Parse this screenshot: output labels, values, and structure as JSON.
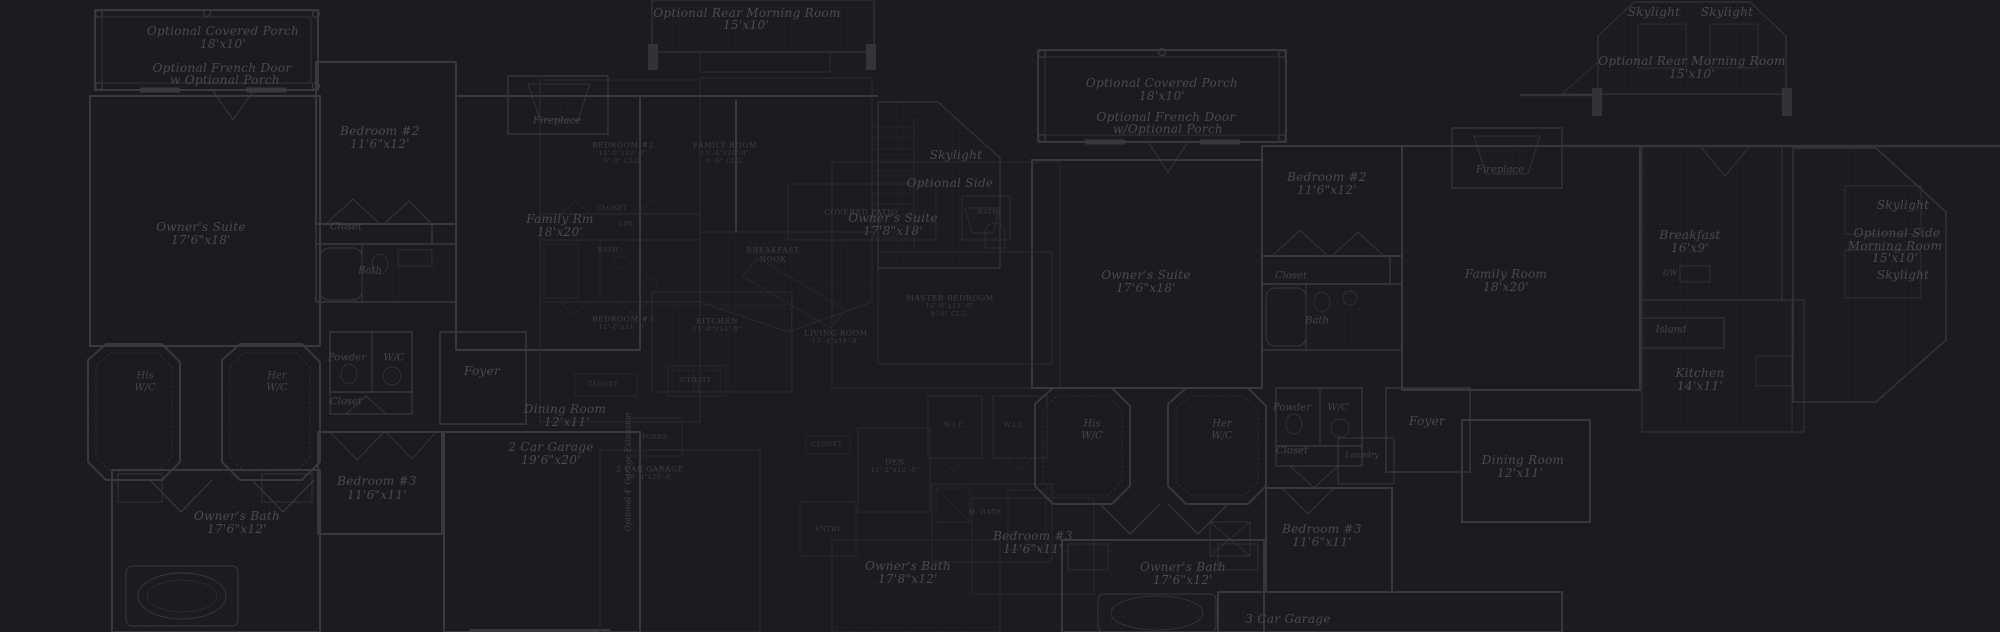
{
  "meta": {
    "title": "Dark floor-plan blueprint collage"
  },
  "canvas": {
    "width": 2000,
    "height": 632,
    "background": "#1c1b1e",
    "wall_color": "#39383f",
    "wall_color_secondary": "#2d2c33",
    "tile_grid_color": "#26252c",
    "label_color_italic": "#4b4854",
    "label_color_caps": "#413e49"
  },
  "labels": [
    {
      "text": "Optional Covered Porch",
      "x": 223,
      "y": 31,
      "cls": "it",
      "name": "label-optional-covered-porch"
    },
    {
      "text": "18'x10'",
      "x": 223,
      "y": 44,
      "cls": "it"
    },
    {
      "text": "Optional French Door",
      "x": 222,
      "y": 68,
      "cls": "it",
      "name": "label-optional-french-door"
    },
    {
      "text": "w Optional Porch",
      "x": 225,
      "y": 80,
      "cls": "it"
    },
    {
      "text": "Bedroom #2",
      "x": 380,
      "y": 131,
      "cls": "it",
      "name": "label-bedroom-2"
    },
    {
      "text": "11'6\"x12'",
      "x": 380,
      "y": 144,
      "cls": "it"
    },
    {
      "text": "Owner's Suite",
      "x": 201,
      "y": 227,
      "cls": "it",
      "name": "label-owners-suite"
    },
    {
      "text": "17'6\"x18'",
      "x": 201,
      "y": 240,
      "cls": "it"
    },
    {
      "text": "Closet",
      "x": 346,
      "y": 227,
      "cls": "itsm"
    },
    {
      "text": "Bath",
      "x": 370,
      "y": 271,
      "cls": "itsm"
    },
    {
      "text": "Fireplace",
      "x": 557,
      "y": 121,
      "cls": "itsm",
      "name": "label-fireplace"
    },
    {
      "text": "Family Rm",
      "x": 560,
      "y": 219,
      "cls": "it",
      "name": "label-family-rm"
    },
    {
      "text": "18'x20'",
      "x": 560,
      "y": 232,
      "cls": "it"
    },
    {
      "text": "His",
      "x": 145,
      "y": 376,
      "cls": "itsm"
    },
    {
      "text": "W/C",
      "x": 145,
      "y": 388,
      "cls": "itsm"
    },
    {
      "text": "Her",
      "x": 277,
      "y": 376,
      "cls": "itsm"
    },
    {
      "text": "W/C",
      "x": 277,
      "y": 388,
      "cls": "itsm"
    },
    {
      "text": "Powder",
      "x": 347,
      "y": 358,
      "cls": "itsm"
    },
    {
      "text": "W/C",
      "x": 394,
      "y": 358,
      "cls": "itsm"
    },
    {
      "text": "Closet",
      "x": 346,
      "y": 402,
      "cls": "itsm"
    },
    {
      "text": "Foyer",
      "x": 482,
      "y": 371,
      "cls": "it",
      "name": "label-foyer"
    },
    {
      "text": "Dining Room",
      "x": 565,
      "y": 409,
      "cls": "it"
    },
    {
      "text": "12'x11'",
      "x": 567,
      "y": 422,
      "cls": "it"
    },
    {
      "text": "Bedroom #3",
      "x": 377,
      "y": 481,
      "cls": "it",
      "name": "label-bedroom-3"
    },
    {
      "text": "11'6\"x11'",
      "x": 377,
      "y": 495,
      "cls": "it"
    },
    {
      "text": "Owner's Bath",
      "x": 237,
      "y": 516,
      "cls": "it",
      "name": "label-owners-bath"
    },
    {
      "text": "17'6\"x12'",
      "x": 237,
      "y": 529,
      "cls": "it"
    },
    {
      "text": "2 Car Garage",
      "x": 551,
      "y": 447,
      "cls": "it",
      "name": "label-2-car-garage"
    },
    {
      "text": "19'6\"x20'",
      "x": 551,
      "y": 460,
      "cls": "it"
    },
    {
      "text": "Optional 4' Garage Extension",
      "x": 628,
      "y": 472,
      "cls": "itxs",
      "rot": true,
      "name": "label-garage-extension"
    },
    {
      "text": "Skylight",
      "x": 956,
      "y": 155,
      "cls": "it",
      "name": "label-skylight"
    },
    {
      "text": "Optional Side",
      "x": 950,
      "y": 183,
      "cls": "it"
    },
    {
      "text": "Owner's Suite",
      "x": 893,
      "y": 218,
      "cls": "it"
    },
    {
      "text": "17'8\"x18'",
      "x": 893,
      "y": 231,
      "cls": "it"
    },
    {
      "text": "Owner's Bath",
      "x": 908,
      "y": 566,
      "cls": "it"
    },
    {
      "text": "17'8\"x12'",
      "x": 908,
      "y": 579,
      "cls": "it"
    },
    {
      "text": "Bedroom #3",
      "x": 1033,
      "y": 536,
      "cls": "it"
    },
    {
      "text": "11'6\"x11'",
      "x": 1033,
      "y": 549,
      "cls": "it"
    },
    {
      "text": "Optional Covered Porch",
      "x": 1162,
      "y": 83,
      "cls": "it"
    },
    {
      "text": "18'x10'",
      "x": 1162,
      "y": 96,
      "cls": "it"
    },
    {
      "text": "Optional French Door",
      "x": 1166,
      "y": 117,
      "cls": "it"
    },
    {
      "text": "w/Optional Porch",
      "x": 1168,
      "y": 129,
      "cls": "it"
    },
    {
      "text": "Bedroom #2",
      "x": 1327,
      "y": 177,
      "cls": "it"
    },
    {
      "text": "11'6\"x12'",
      "x": 1327,
      "y": 190,
      "cls": "it"
    },
    {
      "text": "Owner's Suite",
      "x": 1146,
      "y": 275,
      "cls": "it"
    },
    {
      "text": "17'6\"x18'",
      "x": 1146,
      "y": 288,
      "cls": "it"
    },
    {
      "text": "Closet",
      "x": 1291,
      "y": 276,
      "cls": "itsm"
    },
    {
      "text": "Bath",
      "x": 1317,
      "y": 321,
      "cls": "itsm"
    },
    {
      "text": "Fireplace",
      "x": 1500,
      "y": 170,
      "cls": "itsm"
    },
    {
      "text": "Family Room",
      "x": 1506,
      "y": 274,
      "cls": "it",
      "name": "label-family-room"
    },
    {
      "text": "18'x20'",
      "x": 1506,
      "y": 287,
      "cls": "it"
    },
    {
      "text": "Breakfast",
      "x": 1690,
      "y": 235,
      "cls": "it",
      "name": "label-breakfast"
    },
    {
      "text": "16'x9'",
      "x": 1690,
      "y": 248,
      "cls": "it"
    },
    {
      "text": "DW",
      "x": 1670,
      "y": 273,
      "cls": "itxs"
    },
    {
      "text": "Island",
      "x": 1671,
      "y": 330,
      "cls": "itsm",
      "name": "label-island"
    },
    {
      "text": "Kitchen",
      "x": 1700,
      "y": 373,
      "cls": "it",
      "name": "label-kitchen"
    },
    {
      "text": "14'x11'",
      "x": 1700,
      "y": 386,
      "cls": "it"
    },
    {
      "text": "Skylight",
      "x": 1903,
      "y": 205,
      "cls": "it"
    },
    {
      "text": "Optional Side",
      "x": 1897,
      "y": 233,
      "cls": "it",
      "name": "label-optional-side-morning-room"
    },
    {
      "text": "Morning Room",
      "x": 1895,
      "y": 246,
      "cls": "it"
    },
    {
      "text": "15'x10'",
      "x": 1895,
      "y": 258,
      "cls": "it"
    },
    {
      "text": "Skylight",
      "x": 1903,
      "y": 275,
      "cls": "it"
    },
    {
      "text": "His",
      "x": 1092,
      "y": 424,
      "cls": "itsm"
    },
    {
      "text": "W/C",
      "x": 1092,
      "y": 436,
      "cls": "itsm"
    },
    {
      "text": "Her",
      "x": 1222,
      "y": 424,
      "cls": "itsm"
    },
    {
      "text": "W/C",
      "x": 1222,
      "y": 436,
      "cls": "itsm"
    },
    {
      "text": "Powder",
      "x": 1292,
      "y": 408,
      "cls": "itsm"
    },
    {
      "text": "W/C",
      "x": 1338,
      "y": 408,
      "cls": "itsm"
    },
    {
      "text": "Closet",
      "x": 1292,
      "y": 451,
      "cls": "itsm"
    },
    {
      "text": "Foyer",
      "x": 1427,
      "y": 421,
      "cls": "it"
    },
    {
      "text": "Dining Room",
      "x": 1523,
      "y": 460,
      "cls": "it",
      "name": "label-dining-room"
    },
    {
      "text": "12'x11'",
      "x": 1520,
      "y": 473,
      "cls": "it"
    },
    {
      "text": "Laundry",
      "x": 1362,
      "y": 455,
      "cls": "itxs",
      "name": "label-laundry"
    },
    {
      "text": "Bedroom #3",
      "x": 1322,
      "y": 529,
      "cls": "it"
    },
    {
      "text": "11'6\"x11'",
      "x": 1322,
      "y": 542,
      "cls": "it"
    },
    {
      "text": "Owner's Bath",
      "x": 1183,
      "y": 567,
      "cls": "it"
    },
    {
      "text": "17'6\"x12'",
      "x": 1183,
      "y": 580,
      "cls": "it"
    },
    {
      "text": "3 Car Garage",
      "x": 1288,
      "y": 619,
      "cls": "it",
      "name": "label-3-car-garage"
    },
    {
      "text": "Optional Rear Morning Room",
      "x": 747,
      "y": 13,
      "cls": "it",
      "name": "label-rear-morning-room"
    },
    {
      "text": "15'x10'",
      "x": 746,
      "y": 25,
      "cls": "it"
    },
    {
      "text": "Skylight",
      "x": 1654,
      "y": 12,
      "cls": "it"
    },
    {
      "text": "Skylight",
      "x": 1727,
      "y": 12,
      "cls": "it"
    },
    {
      "text": "Optional Rear Morning Room",
      "x": 1692,
      "y": 61,
      "cls": "it"
    },
    {
      "text": "15'x10'",
      "x": 1692,
      "y": 74,
      "cls": "it"
    },
    {
      "text": "BEDROOM #2",
      "x": 623,
      "y": 145,
      "cls": "caps"
    },
    {
      "text": "11'-0\"x12'-0\"",
      "x": 623,
      "y": 153,
      "cls": "capsxs"
    },
    {
      "text": "9'-0\" CLG.",
      "x": 623,
      "y": 161,
      "cls": "capsxs"
    },
    {
      "text": "FAMILY ROOM",
      "x": 725,
      "y": 145,
      "cls": "caps"
    },
    {
      "text": "15'-4\"x20'-0\"",
      "x": 725,
      "y": 153,
      "cls": "capsxs"
    },
    {
      "text": "9'-0\" CLG.",
      "x": 725,
      "y": 161,
      "cls": "capsxs"
    },
    {
      "text": "CLOSET",
      "x": 612,
      "y": 208,
      "cls": "capsxs"
    },
    {
      "text": "LIN.",
      "x": 627,
      "y": 224,
      "cls": "capsxs"
    },
    {
      "text": "BATH",
      "x": 608,
      "y": 250,
      "cls": "capsxs"
    },
    {
      "text": "BREAKFAST",
      "x": 773,
      "y": 250,
      "cls": "caps"
    },
    {
      "text": "NOOK",
      "x": 773,
      "y": 259,
      "cls": "caps"
    },
    {
      "text": "KITCHEN",
      "x": 717,
      "y": 321,
      "cls": "caps"
    },
    {
      "text": "11'-0\"x14'-0\"",
      "x": 717,
      "y": 329,
      "cls": "capsxs"
    },
    {
      "text": "BEDROOM #3",
      "x": 623,
      "y": 319,
      "cls": "caps"
    },
    {
      "text": "11'-0\"x11'-0\"",
      "x": 623,
      "y": 327,
      "cls": "capsxs"
    },
    {
      "text": "CLOSET",
      "x": 603,
      "y": 384,
      "cls": "capsxs"
    },
    {
      "text": "UTILITY",
      "x": 696,
      "y": 380,
      "cls": "capsxs"
    },
    {
      "text": "LIVING ROOM",
      "x": 836,
      "y": 333,
      "cls": "caps"
    },
    {
      "text": "13'-4\"x18'-0\"",
      "x": 836,
      "y": 341,
      "cls": "capsxs"
    },
    {
      "text": "COVERED PATIO",
      "x": 861,
      "y": 212,
      "cls": "caps"
    },
    {
      "text": "MASTER BEDROOM",
      "x": 950,
      "y": 298,
      "cls": "caps"
    },
    {
      "text": "16'-0\"x13'-0\"",
      "x": 950,
      "y": 306,
      "cls": "capsxs"
    },
    {
      "text": "9'-0\" CLG.",
      "x": 950,
      "y": 314,
      "cls": "capsxs"
    },
    {
      "text": "W.I.C.",
      "x": 955,
      "y": 425,
      "cls": "capsxs"
    },
    {
      "text": "W.I.C.",
      "x": 1015,
      "y": 425,
      "cls": "capsxs"
    },
    {
      "text": "DEN",
      "x": 895,
      "y": 462,
      "cls": "caps"
    },
    {
      "text": "11'-2\"x12'-0\"",
      "x": 895,
      "y": 470,
      "cls": "capsxs"
    },
    {
      "text": "M. BATH",
      "x": 985,
      "y": 512,
      "cls": "capsxs"
    },
    {
      "text": "CLOSET",
      "x": 827,
      "y": 444,
      "cls": "capsxs"
    },
    {
      "text": "ENTRY",
      "x": 828,
      "y": 529,
      "cls": "capsxs"
    },
    {
      "text": "2 CAR GARAGE",
      "x": 650,
      "y": 469,
      "cls": "caps"
    },
    {
      "text": "19'-4\"x20'-0\"",
      "x": 650,
      "y": 477,
      "cls": "capsxs"
    },
    {
      "text": "FOYER",
      "x": 655,
      "y": 437,
      "cls": "capsxs"
    },
    {
      "text": "BATH",
      "x": 988,
      "y": 212,
      "cls": "capsxs"
    }
  ]
}
